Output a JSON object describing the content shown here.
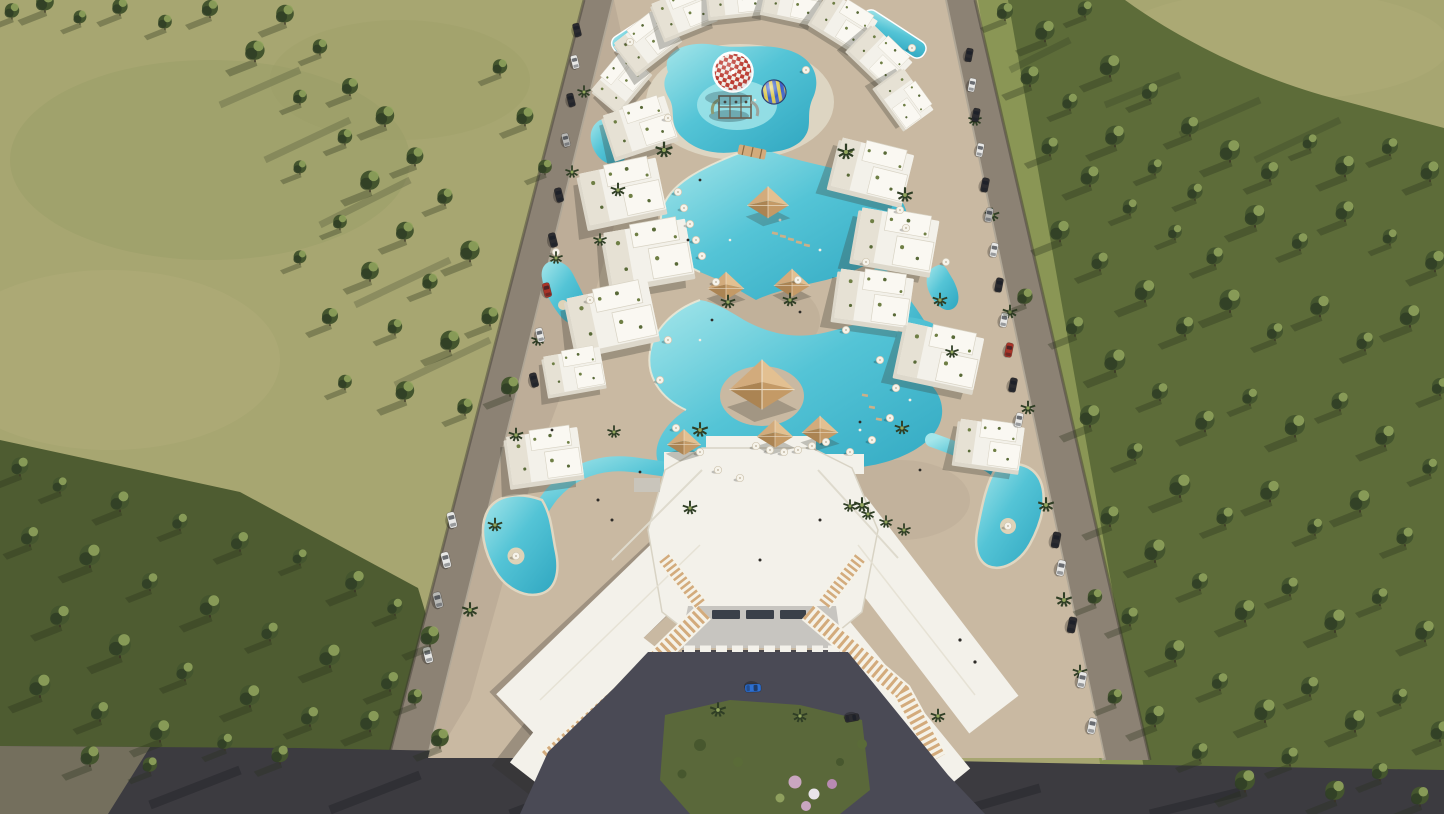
{
  "scene": {
    "type": "3D architectural aerial rendering",
    "description": "Bird's-eye view of a gated resort residential compound: white low-rise apartment clusters with planted roof terraces arranged around free-form turquoise lagoon pools, a kids' aqua park with a red-and-white checkered mushroom parasol and a blue-and-yellow play ball, sandy beach decks with sun umbrellas and shade pavilions, a large white clubhouse with angled wings and timber pergola walkways at the entrance forecourt, perimeter roads lined with parked cars, an olive-green field on the left and dense pine forest on the right",
    "lighting": "low warm sunlight from the upper right casting long tree shadows toward the lower left"
  },
  "colors": {
    "field": "#a7a671",
    "field_light": "#b4b07c",
    "field_dark": "#969c63",
    "forest_ground": "#5d6c39",
    "grass_strip": "#8a9655",
    "grass_dark": "#4e5c31",
    "tree_dark": "#2f3e25",
    "tree_mid": "#44552e",
    "tree_light": "#93a75e",
    "road": "#8c8274",
    "road_dark": "#3c3b40",
    "curb": "#b9b0a0",
    "sand": "#c9b9a2",
    "sand_shade": "#b2a28d",
    "pool": "#54c4d6",
    "pool_deep": "#2fa6c0",
    "pool_light": "#a5e6ea",
    "white_roof": "#f3f1ea",
    "white_wall": "#ddd8cb",
    "wood": "#d3ab7c",
    "wood_dark": "#b08a5a",
    "canopy_gray": "#c7c5c0",
    "courtyard": "#4a4a55",
    "lawn": "#5a683a",
    "island_sand": "#ded3b8",
    "parasol_red": "#bb392e",
    "parasol_white": "#f2efe8",
    "ball_blue": "#3a5fc8",
    "ball_yellow": "#ddc94e",
    "car_white": "#e8e8e6",
    "car_dark": "#2c2c30",
    "car_red": "#a83428",
    "car_blue": "#2d6fd1",
    "car_silver": "#b9b9b6",
    "flower_pink": "#c9a6c0",
    "flower_white": "#e8e3ea"
  },
  "landmarks": {
    "kids_aqua_park": [
      "red-white checkered mushroom parasol",
      "climbing frame with mini slides",
      "blue-yellow striped play ball",
      "shallow splash lagoon"
    ],
    "lagoon_pools": "free-form winding lagoons with sandy decks, white umbrellas and in-water loungers",
    "island_pools": 2,
    "shade_pavilions": 7,
    "clubhouse": [
      "angled white roof wings",
      "timber pergola walkways",
      "glazed entrance canopy",
      "asphalt forecourt",
      "lawn island with flowering shrubs"
    ],
    "apartment_clusters": "white blocks with rooftop planting"
  },
  "vehicles": {
    "forecourt": [
      "blue car",
      "black car"
    ],
    "left_road": "parked and driving cars along the western perimeter",
    "right_road": "parked and driving cars along the eastern perimeter"
  }
}
